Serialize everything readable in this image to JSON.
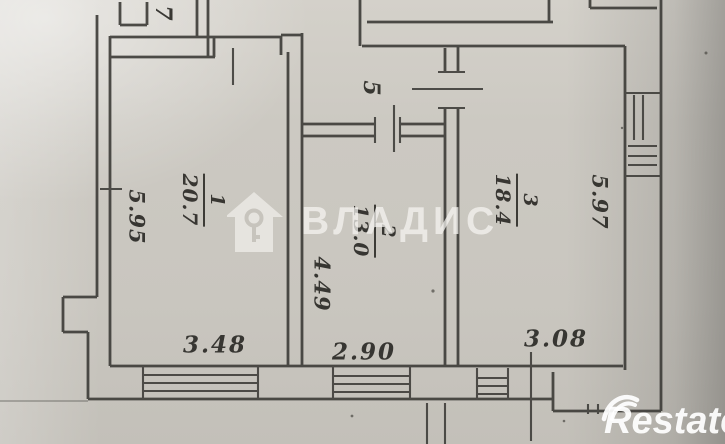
{
  "plan": {
    "rooms": [
      {
        "number": "1",
        "area": "20.7"
      },
      {
        "number": "2",
        "area": "13.0"
      },
      {
        "number": "3",
        "area": "18.4"
      },
      {
        "number": "5"
      },
      {
        "number": "7"
      }
    ],
    "dimensions": {
      "room1_depth": "5.95",
      "room1_width": "3.48",
      "room2_depth": "4.49",
      "room2_width": "2.90",
      "room3_depth": "5.97",
      "room3_width": "3.08"
    }
  },
  "watermarks": {
    "agency_text": "ВЛАДИС",
    "agency_icon": "house-key-icon",
    "portal_text": "Restate",
    "portal_icon": "double-swoosh-icon"
  },
  "colors": {
    "paper": "#cbc8c1",
    "ink": "#3c3b37",
    "watermark_light": "#f7f5f1",
    "watermark_white": "#ffffff"
  }
}
